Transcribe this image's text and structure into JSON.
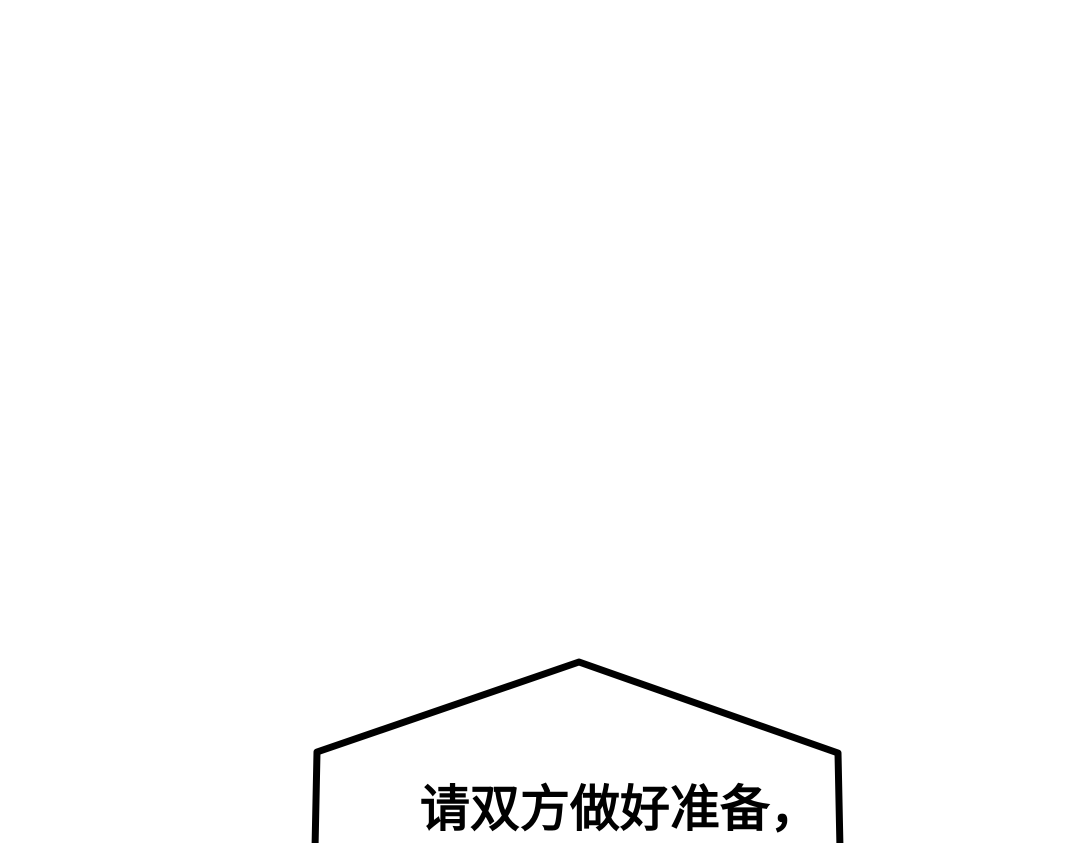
{
  "page": {
    "background_color": "#ffffff"
  },
  "bubble": {
    "type": "speech-bubble",
    "outline_color": "#000000",
    "fill_color": "#ffffff",
    "stroke_width": "7",
    "points": "315,849 317,752 579,662 838,753 840,849",
    "text": "请双方做好准备，",
    "text_color": "#000000"
  }
}
